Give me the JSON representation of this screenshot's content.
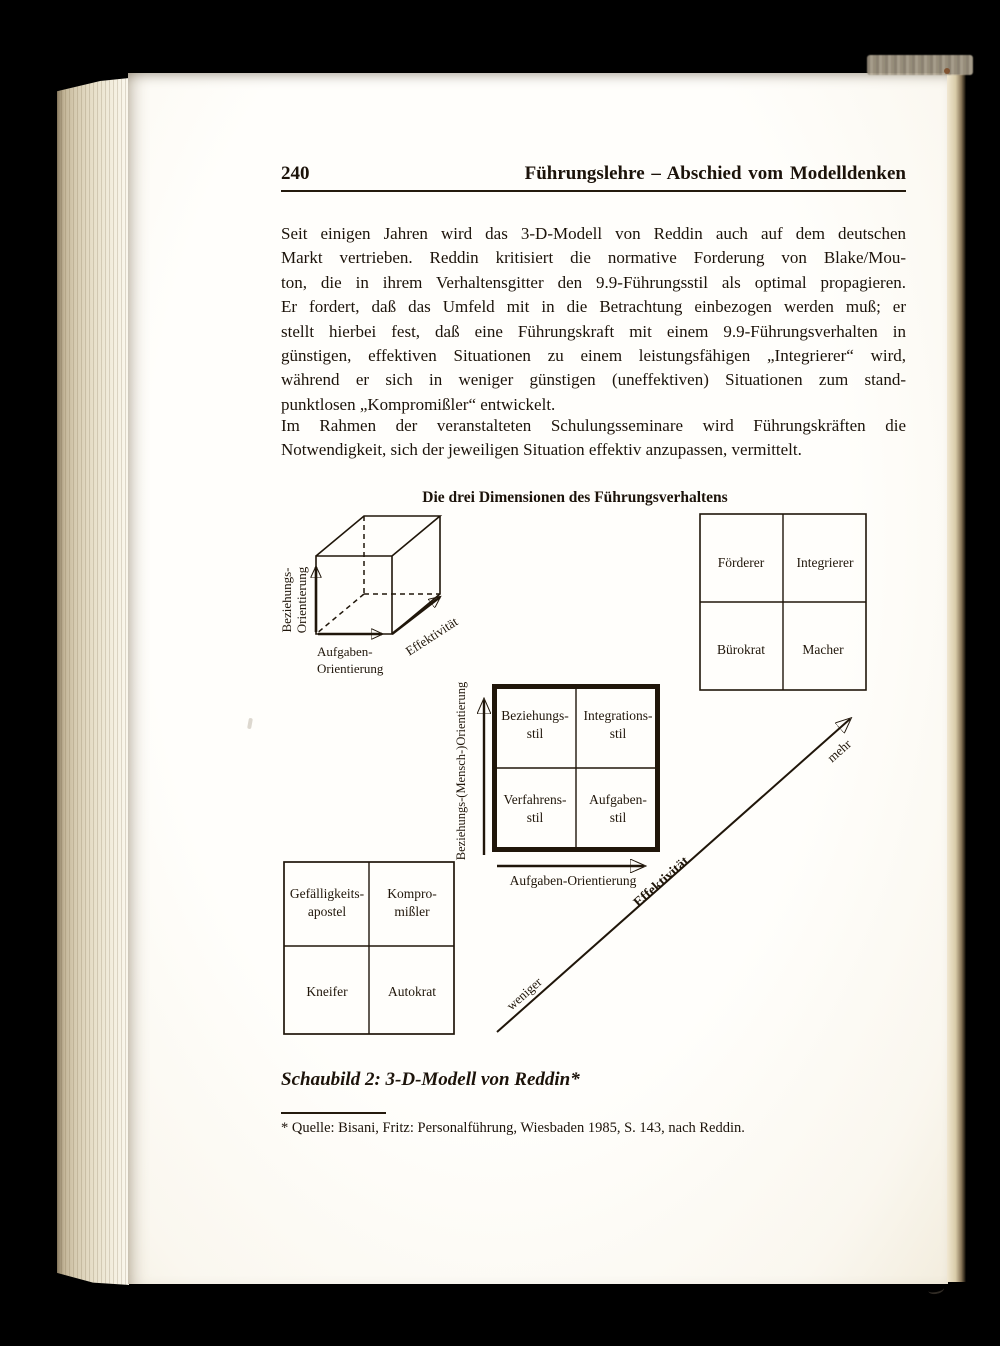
{
  "page": {
    "number": "240",
    "header": "Führungslehre – Abschied vom Modelldenken",
    "paragraph1_lines": [
      "Seit einigen Jahren wird das 3-D-Modell von Reddin auch auf dem deutschen",
      "Markt vertrieben. Reddin kritisiert die normative Forderung von Blake/Mou-",
      "ton, die in ihrem Verhaltensgitter den 9.9-Führungsstil als optimal propagieren.",
      "Er fordert, daß das Umfeld mit in die Betrachtung einbezogen werden muß; er",
      "stellt hierbei fest, daß eine Führungskraft mit einem 9.9-Führungsverhalten in",
      "günstigen, effektiven Situationen zu einem leistungsfähigen „Integrierer“ wird,",
      "während er sich in weniger günstigen (uneffektiven) Situationen zum stand-",
      "punktlosen „Kompromißler“ entwickelt."
    ],
    "paragraph2_lines": [
      "Im Rahmen der veranstalteten Schulungsseminare wird Führungskräften die",
      "Notwendigkeit, sich der jeweiligen Situation effektiv anzupassen, vermittelt."
    ],
    "caption": "Schaubild 2: 3-D-Modell von Reddin*",
    "footnote": "* Quelle: Bisani, Fritz: Personalführung, Wiesbaden 1985, S. 143, nach Reddin."
  },
  "diagram": {
    "title": "Die drei Dimensionen des Führungsverhaltens",
    "cube": {
      "axis_y": [
        "Beziehungs-",
        "Orientierung"
      ],
      "axis_x": [
        "Aufgaben-",
        "Orientierung"
      ],
      "axis_z": "Effektivität"
    },
    "effective_grid": {
      "cells": [
        "Förderer",
        "Integrierer",
        "Bürokrat",
        "Macher"
      ]
    },
    "style_grid": {
      "cells": [
        {
          "line1": "Beziehungs-",
          "line2": "stil"
        },
        {
          "line1": "Integrations-",
          "line2": "stil"
        },
        {
          "line1": "Verfahrens-",
          "line2": "stil"
        },
        {
          "line1": "Aufgaben-",
          "line2": "stil"
        }
      ],
      "y_axis_label": "Beziehungs-(Mensch-)Orientierung",
      "x_axis_label": "Aufgaben-Orientierung"
    },
    "ineffective_grid": {
      "cells": [
        {
          "line1": "Gefälligkeits-",
          "line2": "apostel"
        },
        {
          "line1": "Kompro-",
          "line2": "mißler"
        },
        {
          "line1": "Kneifer",
          "line2": ""
        },
        {
          "line1": "Autokrat",
          "line2": ""
        }
      ]
    },
    "effectiveness_axis": {
      "low": "weniger",
      "label": "Effektivität",
      "high": "mehr"
    }
  }
}
